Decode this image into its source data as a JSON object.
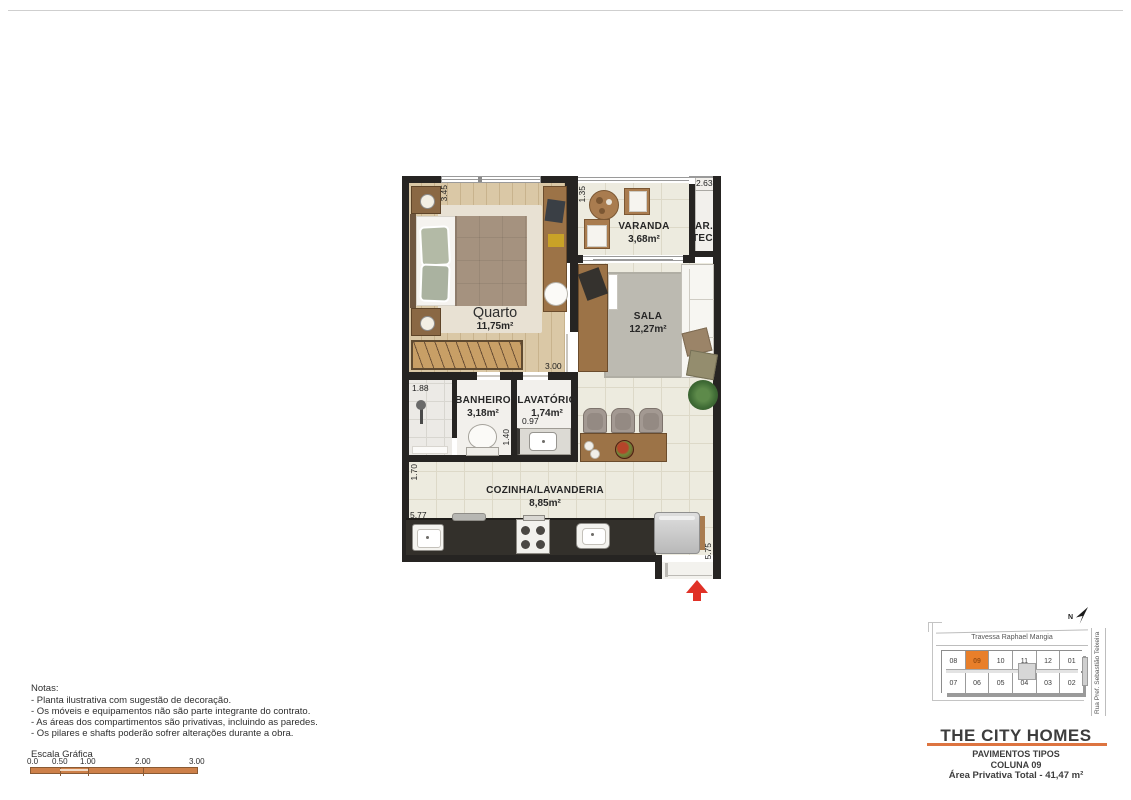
{
  "plan": {
    "rooms": [
      {
        "id": "quarto",
        "name": "Quarto",
        "area": "11,75m²"
      },
      {
        "id": "varanda",
        "name": "VARANDA",
        "area": "3,68m²"
      },
      {
        "id": "artec",
        "line1": "AR.",
        "line2": "TEC."
      },
      {
        "id": "sala",
        "name": "SALA",
        "area": "12,27m²"
      },
      {
        "id": "banheiro",
        "name": "BANHEIRO",
        "area": "3,18m²"
      },
      {
        "id": "lavatorio",
        "name": "LAVATÓRIO",
        "area": "1,74m²"
      },
      {
        "id": "cozinha",
        "name": "COZINHA/LAVANDERIA",
        "area": "8,85m²"
      }
    ],
    "dimensions": {
      "quarto_side": "3.45",
      "varanda_side": "1.35",
      "artec_width": "2.63",
      "quarto_bottom": "3.00",
      "banheiro_width": "1.88",
      "lavatorio_opening": "0.97",
      "banheiro_depth": "1.40",
      "cozinha_side": "1.70",
      "cozinha_width": "5.77",
      "entry_side": "5.75"
    },
    "colors": {
      "wall": "#262422",
      "arrow": "#e03127"
    }
  },
  "notes": {
    "title": "Notas:",
    "items": [
      "- Planta ilustrativa com sugestão de decoração.",
      "- Os móveis e equipamentos não são parte integrante do contrato.",
      "- As áreas dos compartimentos são privativas, incluindo as paredes.",
      "- Os pilares e shafts poderão sofrer alterações durante a obra."
    ]
  },
  "scale": {
    "title": "Escala Gráfica",
    "ticks": [
      "0.0",
      "0.50",
      "1.00",
      "2.00",
      "3.00"
    ],
    "bar_color": "#cd8049"
  },
  "keyplan": {
    "street_top": "Travessa Raphael Mangia",
    "street_right": "Rua Pref. Sebastião Teixeira",
    "north_label": "N",
    "units_top": [
      "08",
      "09",
      "10",
      "11",
      "12",
      "01"
    ],
    "units_bottom": [
      "07",
      "06",
      "05",
      "04",
      "03",
      "02"
    ],
    "highlight_unit": "09",
    "highlight_color": "#e87f2a",
    "highlight_text_color": "#9c4f12"
  },
  "titleblock": {
    "title": "THE CITY HOMES",
    "line1": "PAVIMENTOS TIPOS",
    "line2": "COLUNA 09",
    "line3": "Área Privativa Total - 41,47 m²",
    "accent_color": "#dd7440"
  }
}
